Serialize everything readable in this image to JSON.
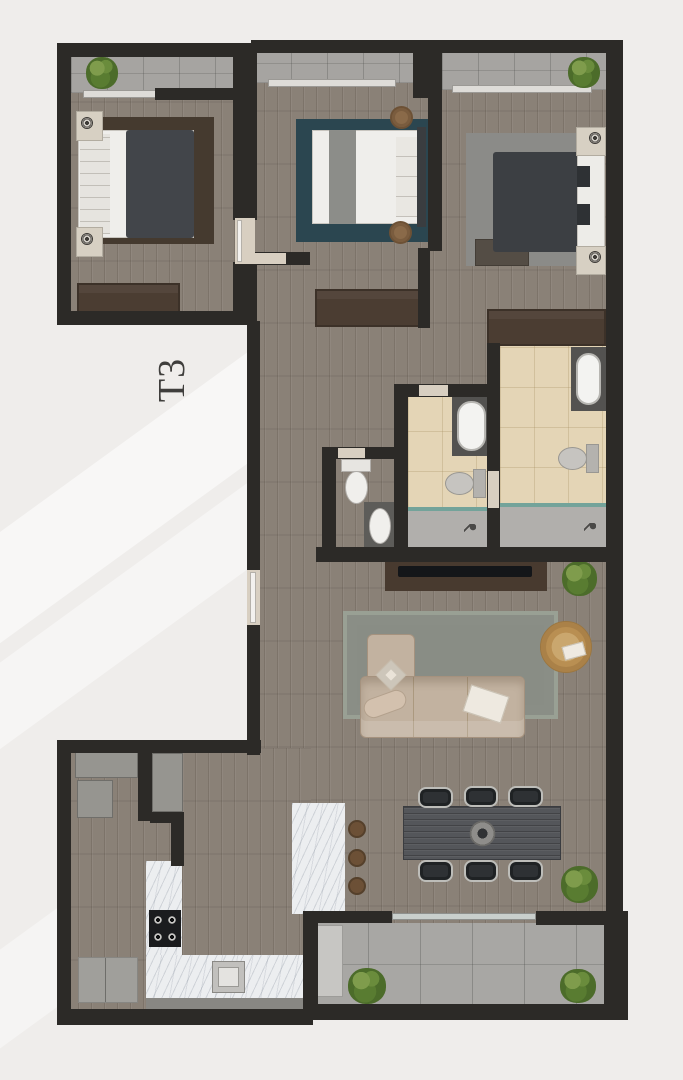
{
  "floor_plan": {
    "unit_label": "T3",
    "type": "apartment-floor-plan-top-view"
  },
  "rooms": [
    {
      "name": "bedroom-1",
      "position": "top-left",
      "furniture": [
        "double-bed",
        "dark-rug",
        "nightstand-with-lamp",
        "nightstand-with-lamp",
        "wardrobe"
      ]
    },
    {
      "name": "bedroom-2",
      "position": "top-middle",
      "furniture": [
        "double-bed",
        "teal-rug",
        "round-stool",
        "round-stool",
        "wardrobe"
      ]
    },
    {
      "name": "bedroom-3",
      "position": "top-right",
      "furniture": [
        "double-bed",
        "grey-rug",
        "nightstand-with-lamp",
        "nightstand-with-lamp",
        "foot-bench",
        "wardrobe"
      ]
    },
    {
      "name": "family-bathroom",
      "furniture": [
        "bathtub",
        "toilet",
        "walk-in-shower"
      ]
    },
    {
      "name": "ensuite-bathroom",
      "furniture": [
        "bathtub",
        "toilet",
        "walk-in-shower"
      ]
    },
    {
      "name": "guest-wc",
      "furniture": [
        "toilet",
        "washbasin"
      ]
    },
    {
      "name": "hallway",
      "furniture": []
    },
    {
      "name": "living-room",
      "furniture": [
        "tv-console",
        "tv",
        "corner-sofa",
        "rug",
        "rattan-armchair",
        "plant"
      ]
    },
    {
      "name": "dining-area",
      "furniture": [
        "dining-table",
        "six-chairs",
        "centerpiece-bowl",
        "plant"
      ]
    },
    {
      "name": "kitchen",
      "furniture": [
        "l-shaped-counter",
        "cooktop",
        "sink",
        "island",
        "three-bar-stools"
      ]
    },
    {
      "name": "utility-room",
      "furniture": [
        "appliance",
        "appliance",
        "counter"
      ]
    },
    {
      "name": "balcony-top-left",
      "furniture": [
        "plant"
      ]
    },
    {
      "name": "balcony-top-middle",
      "furniture": []
    },
    {
      "name": "balcony-top-right",
      "furniture": [
        "plant"
      ]
    },
    {
      "name": "balcony-bottom",
      "furniture": [
        "plant",
        "plant"
      ]
    }
  ],
  "counts": {
    "bedrooms": 3,
    "bathrooms": 2,
    "wc": 1,
    "balconies": 4,
    "dining_chairs": 6,
    "bar_stools": 3
  },
  "colors": {
    "background": "#efedeb",
    "wall": "#2c2a27",
    "wood_floor": "#8a8177",
    "balcony_stone": "#a6a4a1",
    "bathroom_tile": "#e4d5b6",
    "shower_floor": "#b1afac",
    "shower_glass": "#73a39a",
    "marble_counter": "#eceef0",
    "wardrobe_brown": "#4b3d32",
    "bedroom1_rug": "#453a2f",
    "bedroom2_rug": "#2b4650",
    "bedroom3_rug": "#8b8b88",
    "living_rug": "#898d85",
    "sofa_beige": "#c2b2a0",
    "rattan_chair": "#bf9961",
    "dining_table": "#54565a",
    "duvet_dark": "#3e4144",
    "linen_white": "#efeeeb",
    "plant_green": "#5f7f37",
    "label_text": "#3f3e3c"
  }
}
